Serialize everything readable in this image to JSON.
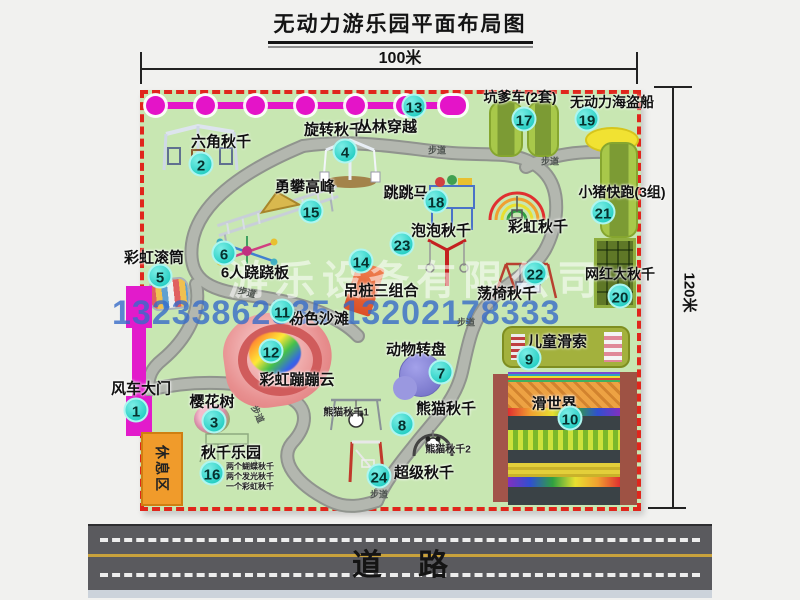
{
  "title": "无动力游乐园平面布局图",
  "dimensions": {
    "top": "100米",
    "right": "120米"
  },
  "watermark": {
    "company": "游乐设备有限公司",
    "phone": "13233862535 13202178333"
  },
  "road": {
    "label": "道路"
  },
  "map": {
    "rest_area_label": "休息区",
    "path_label": "步道",
    "attractions": [
      {
        "num": "1",
        "name": "风车大门",
        "bx": 136,
        "by": 410,
        "lx": 141,
        "ly": 388
      },
      {
        "num": "2",
        "name": "六角秋千",
        "bx": 201,
        "by": 164,
        "lx": 221,
        "ly": 141
      },
      {
        "num": "3",
        "name": "樱花树",
        "bx": 214,
        "by": 421,
        "lx": 212,
        "ly": 401
      },
      {
        "num": "4",
        "name": "旋转秋千",
        "bx": 345,
        "by": 151,
        "lx": 334,
        "ly": 129
      },
      {
        "num": "5",
        "name": "彩虹滚筒",
        "bx": 160,
        "by": 276,
        "lx": 154,
        "ly": 257
      },
      {
        "num": "6",
        "name": "6人跷跷板",
        "bx": 224,
        "by": 253,
        "lx": 255,
        "ly": 272
      },
      {
        "num": "7",
        "name": "动物转盘",
        "bx": 441,
        "by": 372,
        "lx": 416,
        "ly": 349
      },
      {
        "num": "8",
        "name": "熊猫秋千",
        "bx": 402,
        "by": 424,
        "lx": 446,
        "ly": 408
      },
      {
        "num": "9",
        "name": "儿童滑索",
        "bx": 529,
        "by": 358,
        "lx": 557,
        "ly": 341
      },
      {
        "num": "10",
        "name": "滑世界",
        "bx": 570,
        "by": 418,
        "lx": 554,
        "ly": 403
      },
      {
        "num": "11",
        "name": "粉色沙滩",
        "bx": 282,
        "by": 311,
        "lx": 319,
        "ly": 318
      },
      {
        "num": "12",
        "name": "彩虹蹦蹦云",
        "bx": 271,
        "by": 351,
        "lx": 297,
        "ly": 379
      },
      {
        "num": "13",
        "name": "丛林穿越",
        "bx": 414,
        "by": 106,
        "lx": 387,
        "ly": 126
      },
      {
        "num": "14",
        "name": "吊桩三组合",
        "bx": 361,
        "by": 261,
        "lx": 381,
        "ly": 290
      },
      {
        "num": "15",
        "name": "勇攀高峰",
        "bx": 311,
        "by": 211,
        "lx": 305,
        "ly": 186
      },
      {
        "num": "16",
        "name": "秋千乐园",
        "bx": 212,
        "by": 473,
        "lx": 231,
        "ly": 452
      },
      {
        "num": "17",
        "name": "坑爹车(2套)",
        "fs": 14,
        "bx": 524,
        "by": 119,
        "lx": 520,
        "ly": 97
      },
      {
        "num": "18",
        "name": "跳跳马",
        "bx": 436,
        "by": 201,
        "lx": 406,
        "ly": 192
      },
      {
        "num": "19",
        "name": "无动力海盗船",
        "fs": 14,
        "bx": 587,
        "by": 119,
        "lx": 612,
        "ly": 102
      },
      {
        "num": "20",
        "name": "网红大秋千",
        "fs": 14,
        "bx": 620,
        "by": 296,
        "lx": 620,
        "ly": 274
      },
      {
        "num": "21",
        "name": "小猪快跑(3组)",
        "fs": 14,
        "bx": 603,
        "by": 212,
        "lx": 622,
        "ly": 192
      },
      {
        "num": "22",
        "name": "荡椅秋千",
        "bx": 535,
        "by": 273,
        "lx": 507,
        "ly": 293
      },
      {
        "num": "23",
        "name": "泡泡秋千",
        "bx": 402,
        "by": 244,
        "lx": 441,
        "ly": 230
      },
      {
        "num": "24",
        "name": "超级秋千",
        "bx": 379,
        "by": 476,
        "lx": 424,
        "ly": 472
      },
      {
        "num": "",
        "name": "彩虹秋千",
        "bx": 0,
        "by": 0,
        "lx": 538,
        "ly": 226
      }
    ],
    "sub_labels": [
      {
        "text": "熊猫秋千1",
        "x": 346,
        "y": 411
      },
      {
        "text": "熊猫秋千2",
        "x": 448,
        "y": 448
      }
    ],
    "swing_notes": [
      "两个蝴蝶秋千",
      "两个发光秋千",
      "一个彩虹秋千"
    ],
    "path_labels": [
      {
        "x": 247,
        "y": 292,
        "rot": 15
      },
      {
        "x": 437,
        "y": 150,
        "rot": 0
      },
      {
        "x": 550,
        "y": 161,
        "rot": 0
      },
      {
        "x": 466,
        "y": 322,
        "rot": 0
      },
      {
        "x": 379,
        "y": 494,
        "rot": 0
      },
      {
        "x": 258,
        "y": 414,
        "rot": 65
      }
    ]
  }
}
